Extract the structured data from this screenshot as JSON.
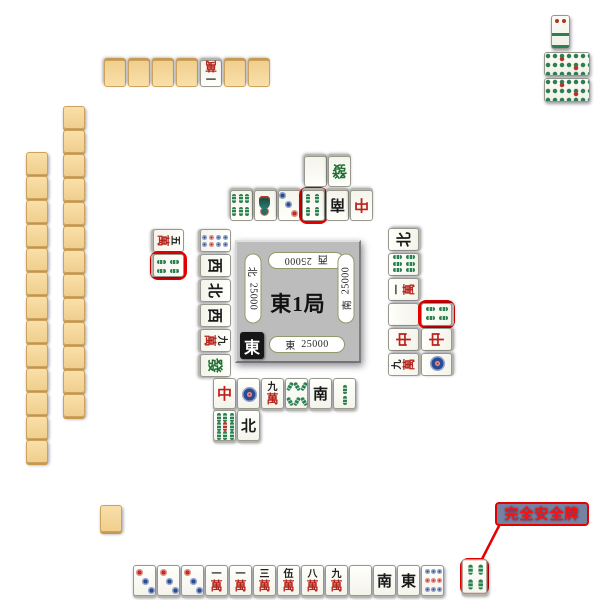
{
  "center": {
    "round": "東1局",
    "dealer_marker": "東",
    "seats": {
      "bottom": {
        "wind": "東",
        "score": "25000"
      },
      "right": {
        "wind": "南",
        "score": "25000"
      },
      "top": {
        "wind": "西",
        "score": "25000"
      },
      "left": {
        "wind": "北",
        "score": "25000"
      }
    }
  },
  "callout": {
    "label": "完全安全牌"
  },
  "colors": {
    "highlight": "#e60000",
    "table_center": "#2a63dd",
    "table_edge": "#081a52",
    "tile_back": "#f6d79e",
    "board_gray": "#bcbcbc"
  },
  "hands": {
    "bottom": [
      "3p",
      "3p",
      "3p",
      "1m",
      "1m",
      "3m",
      "5m",
      "8m",
      "9m",
      "haku",
      "nan",
      "ton",
      "9p"
    ]
  },
  "discards": {
    "bottom": {
      "row1": [
        "chun",
        "1p",
        "9m",
        "8s",
        "nan",
        "2s"
      ],
      "row2": [
        "9s",
        "pei"
      ]
    },
    "top": {
      "row1": [
        "6s",
        "1s",
        "3p",
        "4s*",
        "nan",
        "chun"
      ],
      "row2": [
        "haku",
        "hatsu"
      ]
    },
    "left": {
      "col1": [
        "8p",
        "sha",
        "pei",
        "sha",
        "9m",
        "hatsu"
      ],
      "col2": [
        "5M",
        "4s*"
      ]
    },
    "right": {
      "col1": [
        "pei",
        "6s",
        "1m",
        "haku",
        "chun",
        "9m"
      ],
      "col2": [
        "4s*",
        "chun",
        "1p"
      ]
    }
  },
  "walls": {
    "top": [
      "back",
      "back",
      "back",
      "back",
      "1m",
      "back",
      "back"
    ],
    "left_outer": [
      "back",
      "back",
      "back",
      "back",
      "back",
      "back",
      "back",
      "back",
      "back",
      "back",
      "back",
      "back",
      "back"
    ],
    "left_inner": [
      "back",
      "back",
      "back",
      "back",
      "back",
      "back",
      "back",
      "back",
      "back",
      "back",
      "back",
      "back",
      "back"
    ],
    "bottom_stub": [
      "back"
    ]
  },
  "safe_tile": [
    "4s*"
  ],
  "tiles": {
    "man_glyph": "萬",
    "defs": {
      "1m": {
        "suit": "man",
        "n": "一"
      },
      "3m": {
        "suit": "man",
        "n": "三"
      },
      "5m": {
        "suit": "man",
        "n": "伍"
      },
      "5M": {
        "suit": "man",
        "n": "五"
      },
      "8m": {
        "suit": "man",
        "n": "八"
      },
      "9m": {
        "suit": "man",
        "n": "九"
      },
      "1p": {
        "suit": "pin",
        "pattern": "p1"
      },
      "3p": {
        "suit": "pin",
        "pattern": "p3"
      },
      "8p": {
        "suit": "pin",
        "pattern": "p8"
      },
      "9p": {
        "suit": "pin",
        "pattern": "p9"
      },
      "1s": {
        "suit": "sou",
        "pattern": "s1"
      },
      "2s": {
        "suit": "sou",
        "pattern": "s2"
      },
      "4s": {
        "suit": "sou",
        "pattern": "s4"
      },
      "6s": {
        "suit": "sou",
        "pattern": "s6"
      },
      "8s": {
        "suit": "sou",
        "pattern": "s8"
      },
      "9s": {
        "suit": "sou",
        "pattern": "s9"
      },
      "ton": {
        "suit": "honor",
        "ch": "東",
        "color": "#1a1a1a"
      },
      "nan": {
        "suit": "honor",
        "ch": "南",
        "color": "#1a1a1a"
      },
      "sha": {
        "suit": "honor",
        "ch": "西",
        "color": "#1a1a1a"
      },
      "pei": {
        "suit": "honor",
        "ch": "北",
        "color": "#1a1a1a"
      },
      "chun": {
        "suit": "honor",
        "ch": "中",
        "color": "#c01f1a"
      },
      "hatsu": {
        "suit": "honor",
        "ch": "發",
        "color": "#1d6e2f"
      },
      "haku": {
        "suit": "honor",
        "ch": "",
        "color": "#ffffff"
      },
      "back": {
        "suit": "back"
      }
    }
  }
}
